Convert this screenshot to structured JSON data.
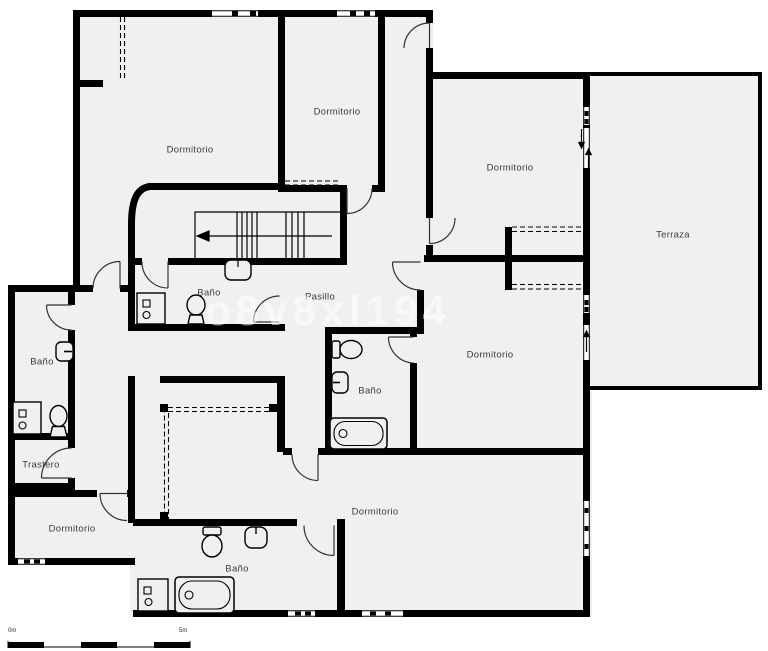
{
  "plan": {
    "watermark": "o8v8xl194",
    "colors": {
      "wall": "#000000",
      "room_fill": "#f0f0f0",
      "label_text": "#3b3b3b",
      "watermark": "#ffffff",
      "background": "#ffffff"
    },
    "rooms": [
      {
        "label": "Dormitorio",
        "x": 190,
        "y": 150
      },
      {
        "label": "Dormitorio",
        "x": 337,
        "y": 112
      },
      {
        "label": "Dormitorio",
        "x": 510,
        "y": 168
      },
      {
        "label": "Terraza",
        "x": 673,
        "y": 235
      },
      {
        "label": "Pasillo",
        "x": 320,
        "y": 297
      },
      {
        "label": "Baño",
        "x": 209,
        "y": 293
      },
      {
        "label": "Baño",
        "x": 42,
        "y": 362
      },
      {
        "label": "Trastero",
        "x": 41,
        "y": 465
      },
      {
        "label": "Dormitorio",
        "x": 72,
        "y": 529
      },
      {
        "label": "Baño",
        "x": 370,
        "y": 391
      },
      {
        "label": "Dormitorio",
        "x": 490,
        "y": 355
      },
      {
        "label": "Dormitorio",
        "x": 375,
        "y": 512
      },
      {
        "label": "Baño",
        "x": 237,
        "y": 569
      }
    ],
    "scale_bar": {
      "start_label": "0m",
      "end_label": "5m"
    }
  }
}
